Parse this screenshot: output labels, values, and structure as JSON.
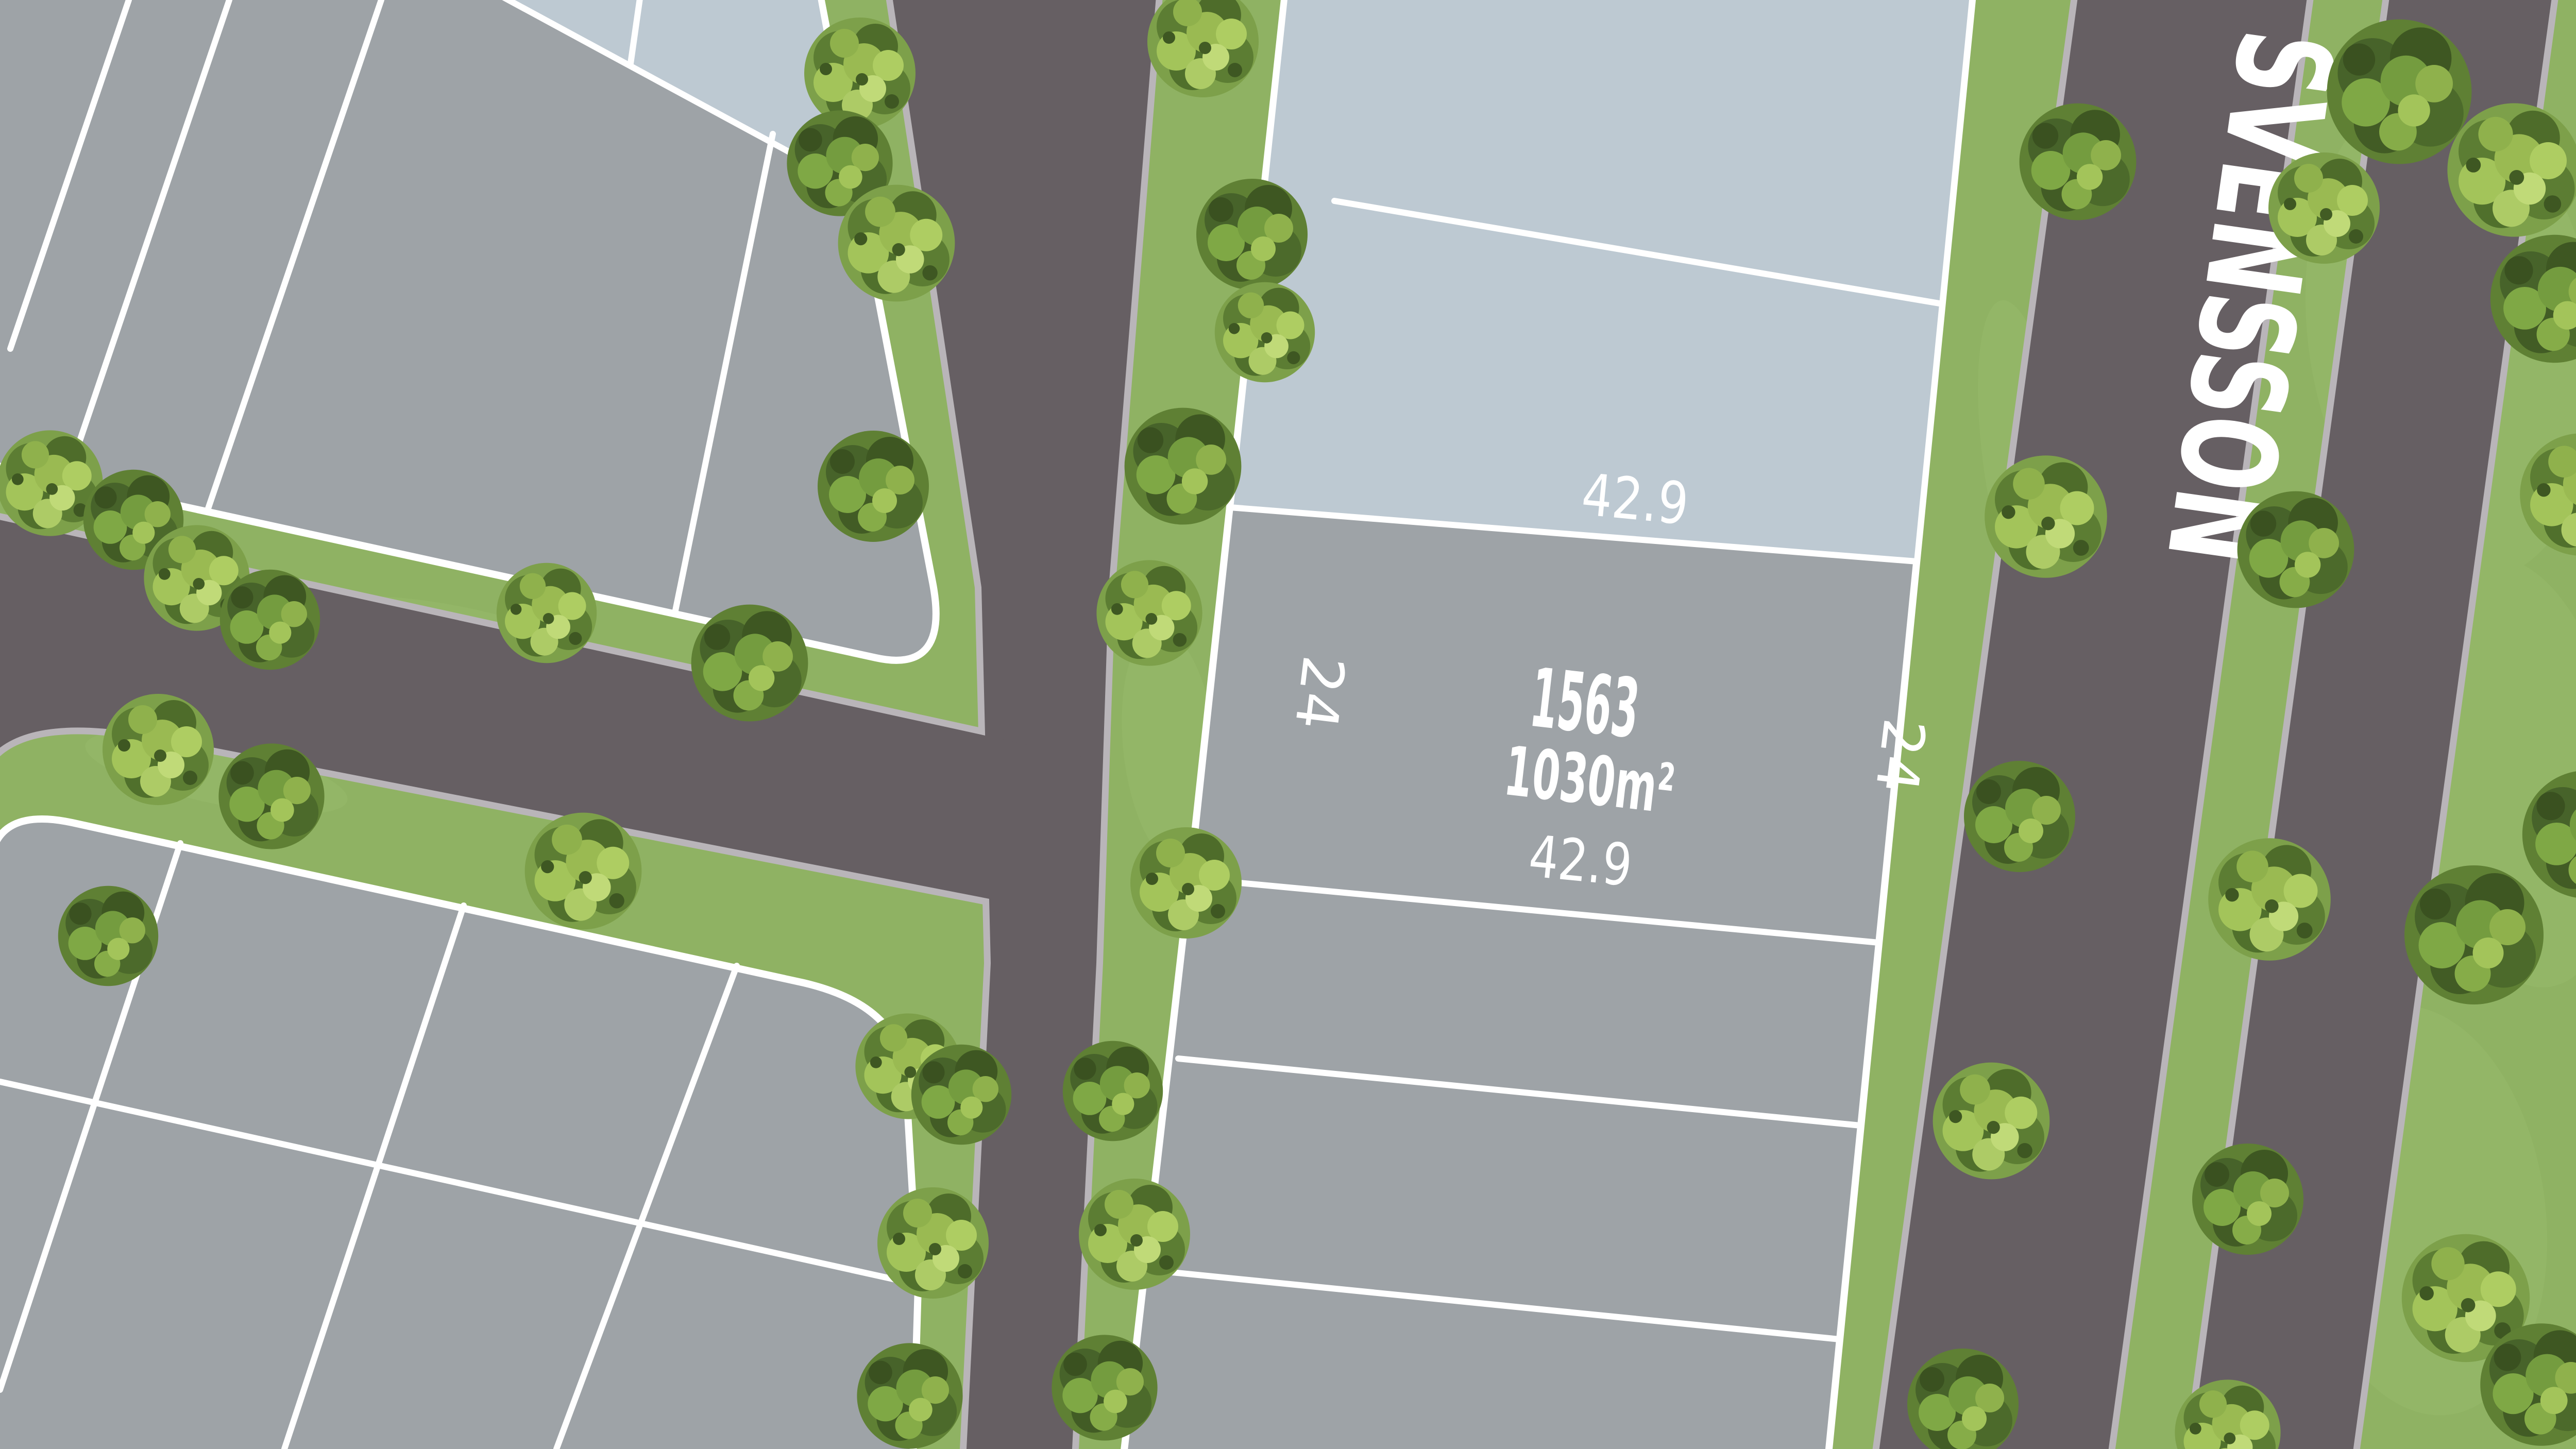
{
  "plan": {
    "street": {
      "name": "SVENSSON"
    },
    "lot": {
      "number": "1563",
      "area": "1030m²",
      "dim_top": "42.9",
      "dim_bottom": "42.9",
      "dim_left": "24",
      "dim_right": "24"
    },
    "legend": {
      "available_lot_color": "#9EA3A7",
      "unavailable_lot_color": "#BDC9D2",
      "road_color": "#665F63",
      "curb_color": "#B9B5B9",
      "grass_color": "#8FB263",
      "boundary_line_color": "#FFFFFF",
      "label_color": "#FFFFFF"
    }
  }
}
